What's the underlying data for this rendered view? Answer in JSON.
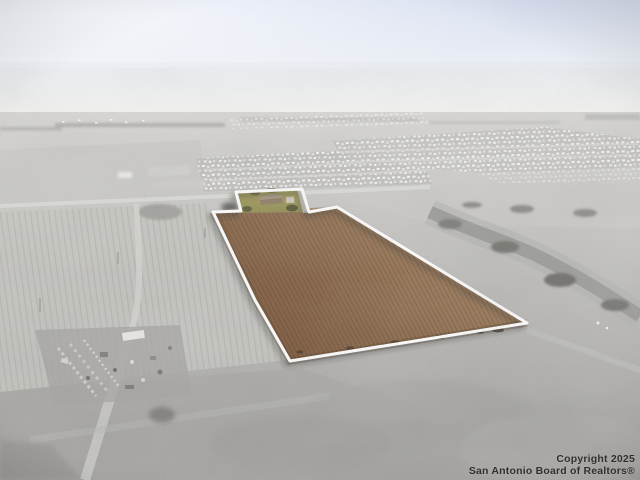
{
  "watermark": {
    "line1": "Copyright 2025",
    "line2": "San Antonio Board of Realtors®"
  },
  "colors": {
    "sky_top": "#d8dff0",
    "sky_horizon": "#f7f6f1",
    "ground_far_gray": "#d8d7d4",
    "ground_near_gray": "#9c9b98",
    "parcel_soil_light": "#9c7a57",
    "parcel_soil_dark": "#744f31",
    "boundary_outline": "#ffffff",
    "homestead_grass": "#a9a25d",
    "homestead_trees": "#5c5b36",
    "subdivision_houses": "#ffffff",
    "creek_trees": "#73726e",
    "watermark_text": "#2f2e2c"
  }
}
